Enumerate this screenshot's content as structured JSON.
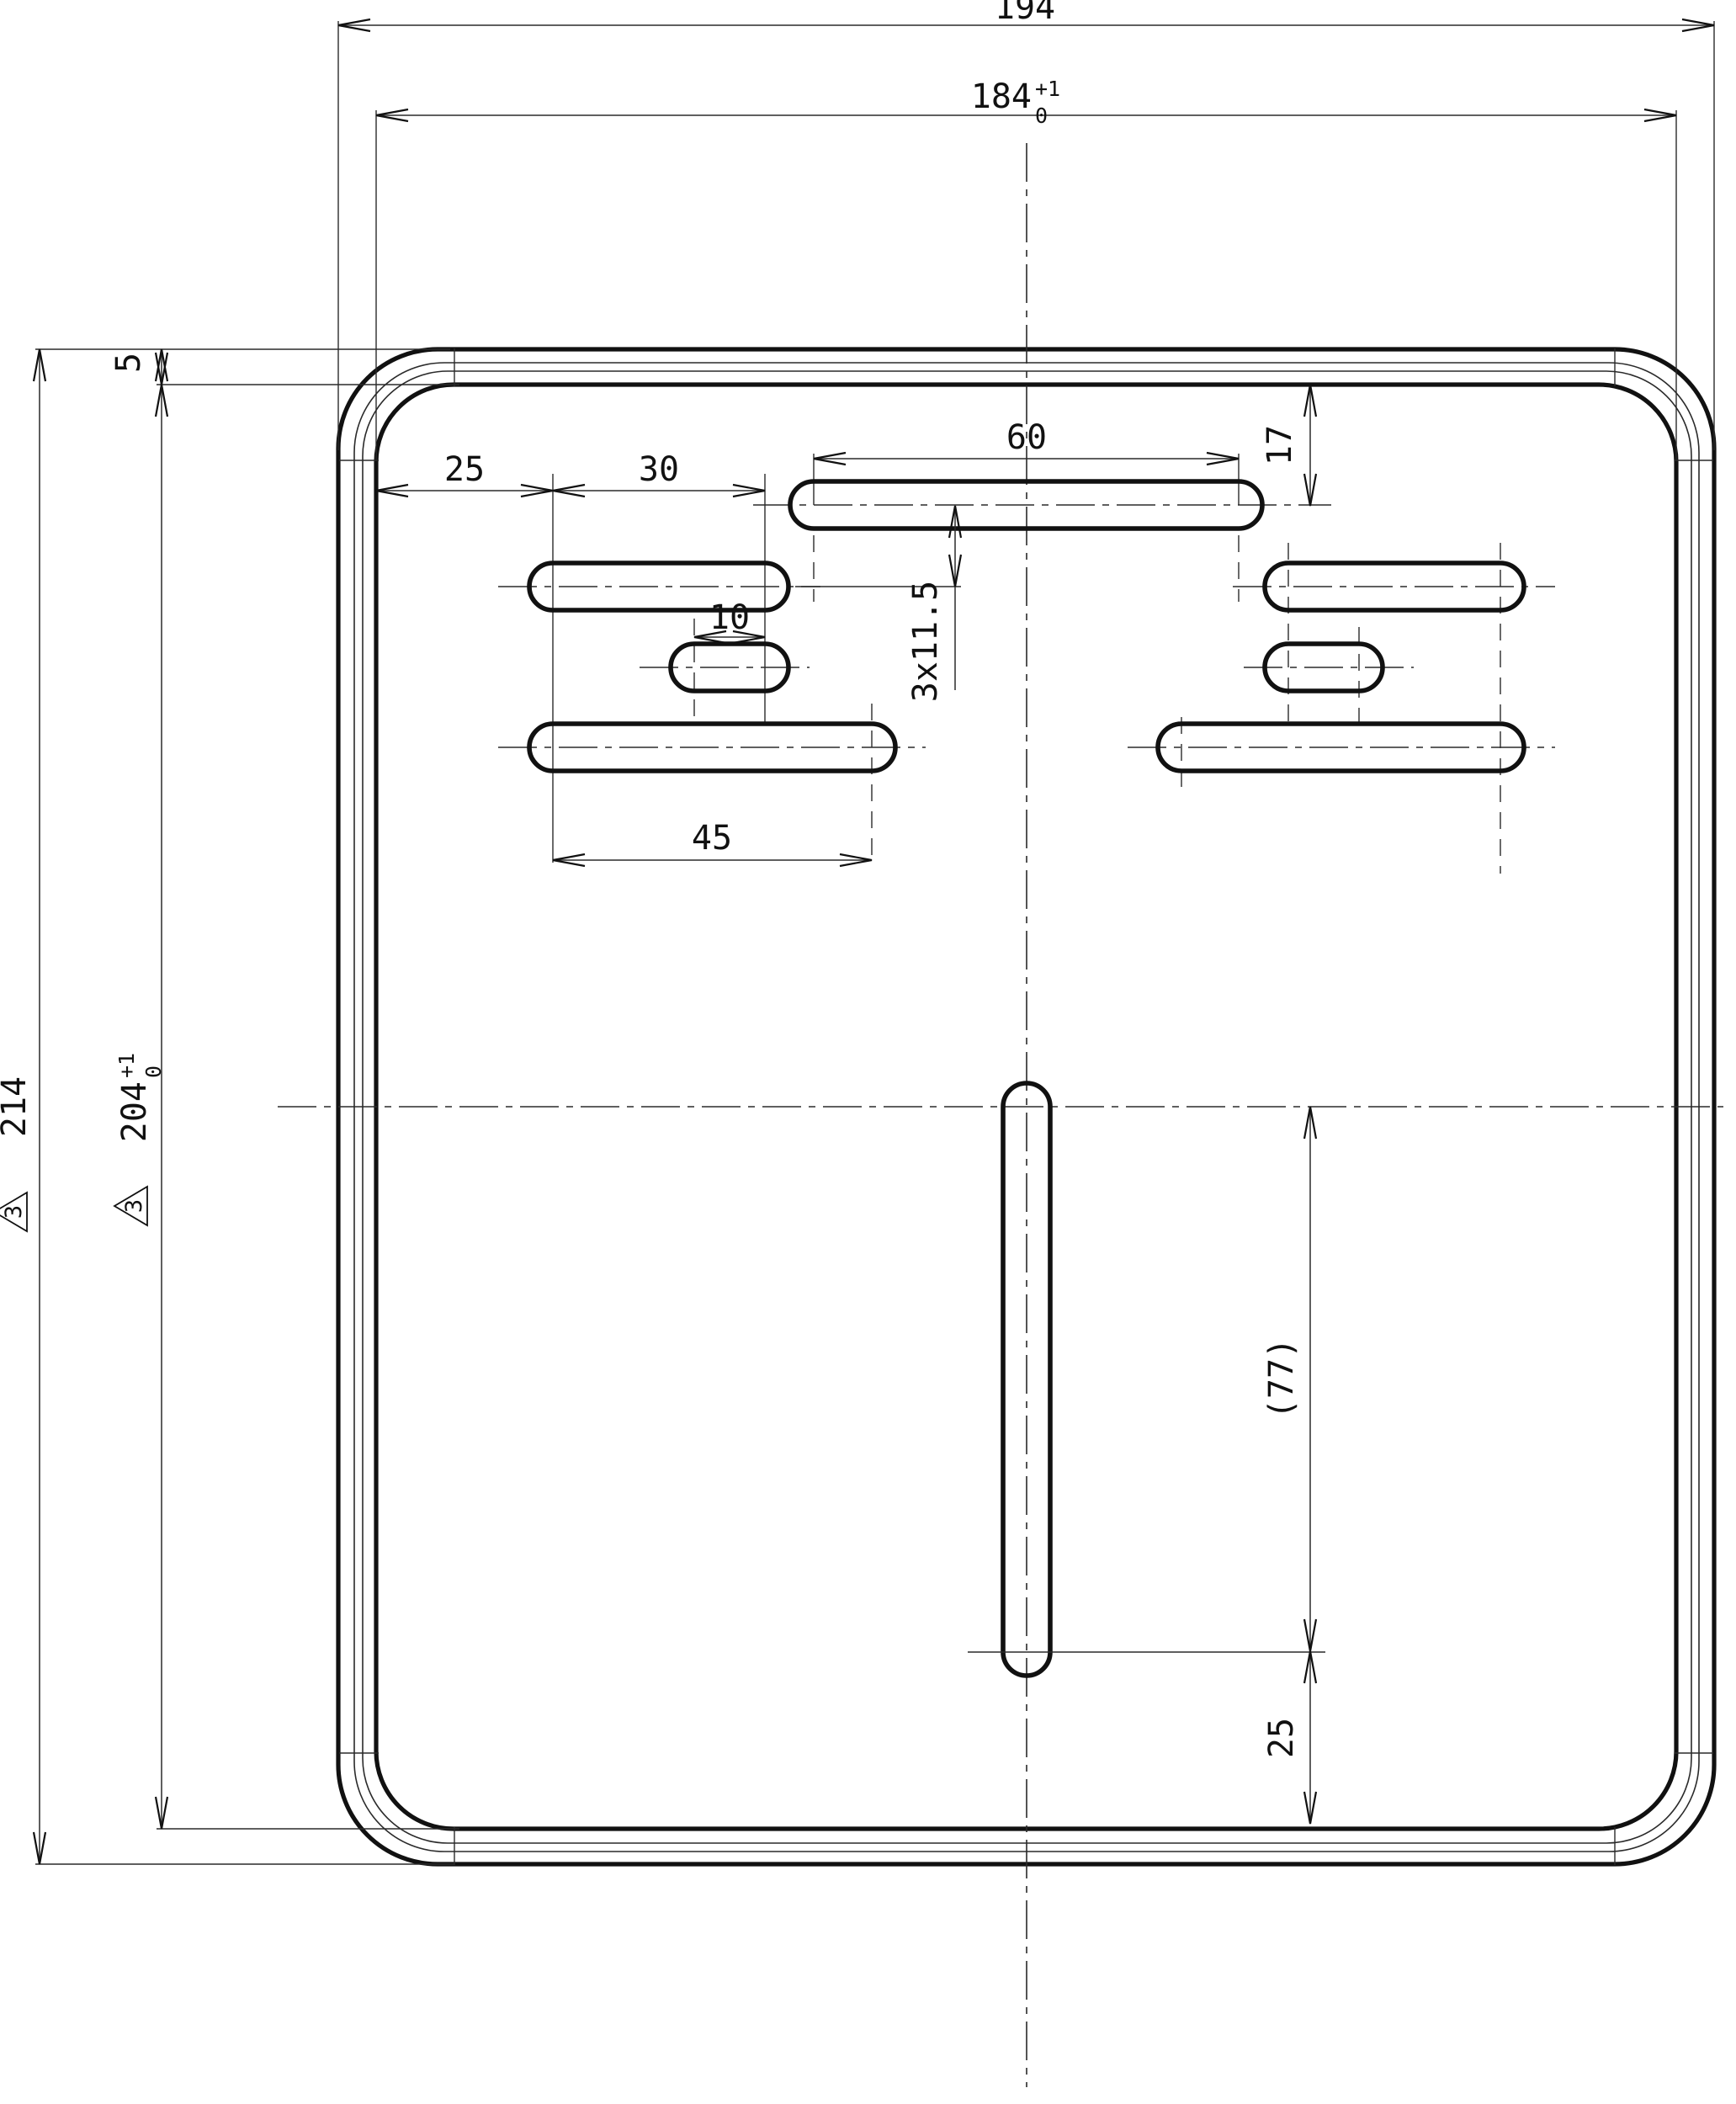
{
  "drawing": {
    "dims": {
      "w_outer": "194",
      "w_inner": "184",
      "w_inner_tu": "+1",
      "w_inner_tl": "0",
      "h_outer": "214",
      "h_outer_flag": "3",
      "h_inner": "204",
      "h_inner_tu": "+1",
      "h_inner_tl": "0",
      "h_inner_flag": "3",
      "rim_offset": "5",
      "top_slot_length": "60",
      "top_slot_from_edge": "17",
      "slot_left_margin": "25",
      "slot_step": "30",
      "small_slot_length": "10",
      "lower_slot_length": "45",
      "row_pitch": "3x11.5",
      "center_slot_length": "(77)",
      "center_slot_bottom_margin": "25"
    }
  }
}
